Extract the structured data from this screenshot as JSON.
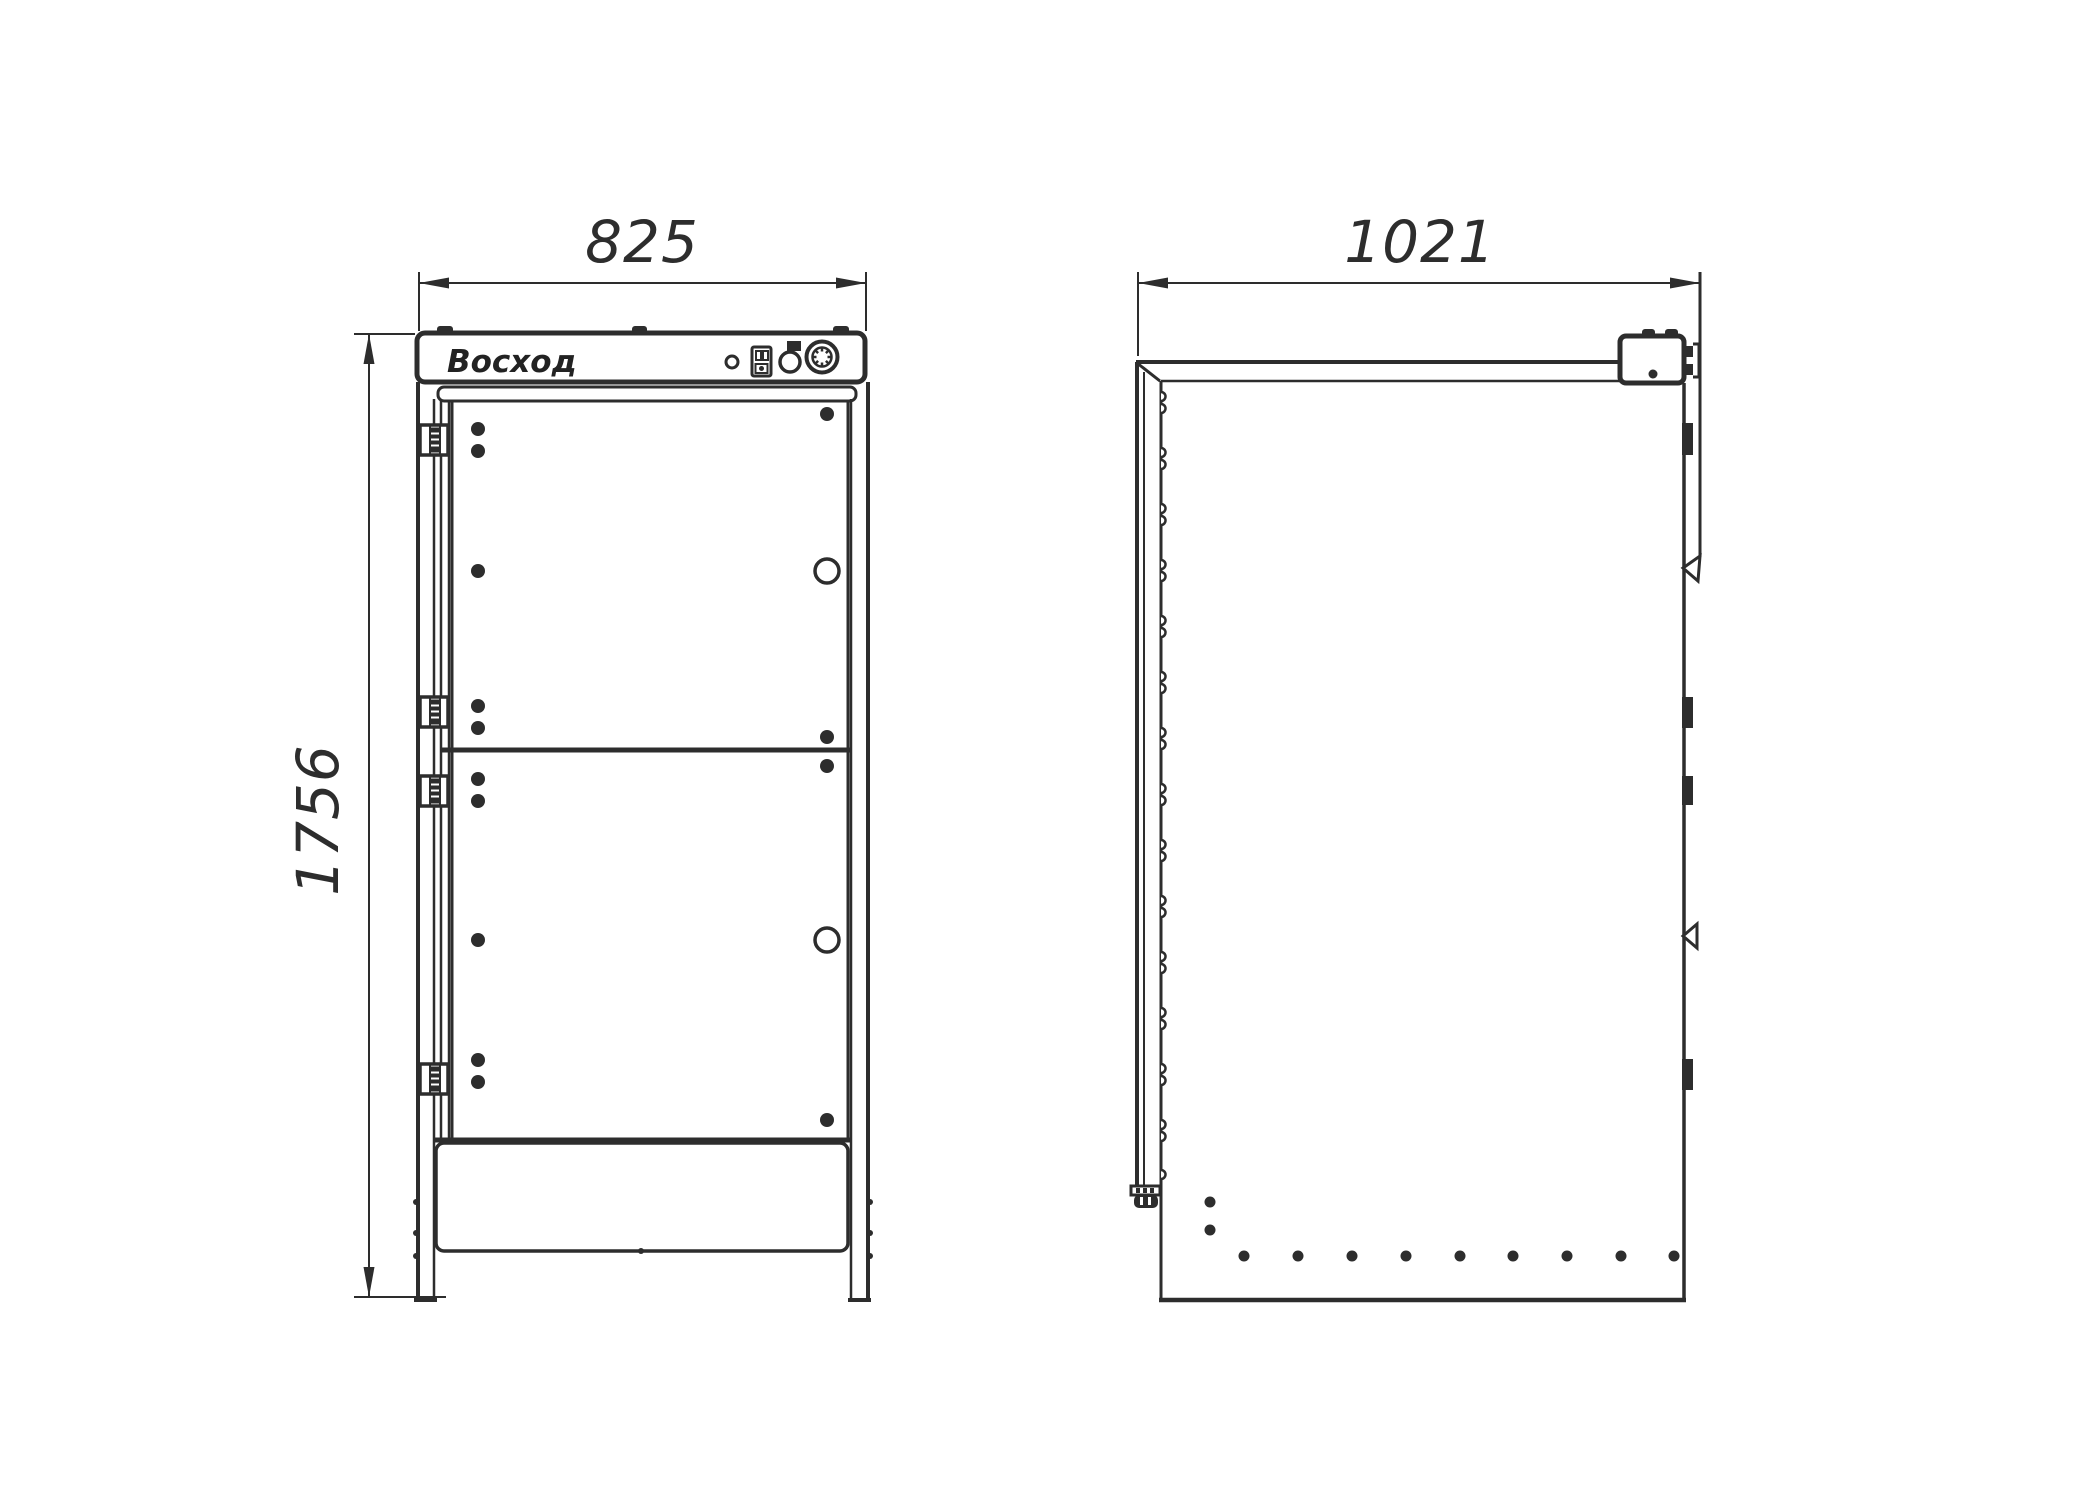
{
  "drawing": {
    "brand": "Восход",
    "dim_width": "825",
    "dim_depth": "1021",
    "dim_height": "1756",
    "line_color": "#2d2d2d",
    "background": "#ffffff"
  }
}
